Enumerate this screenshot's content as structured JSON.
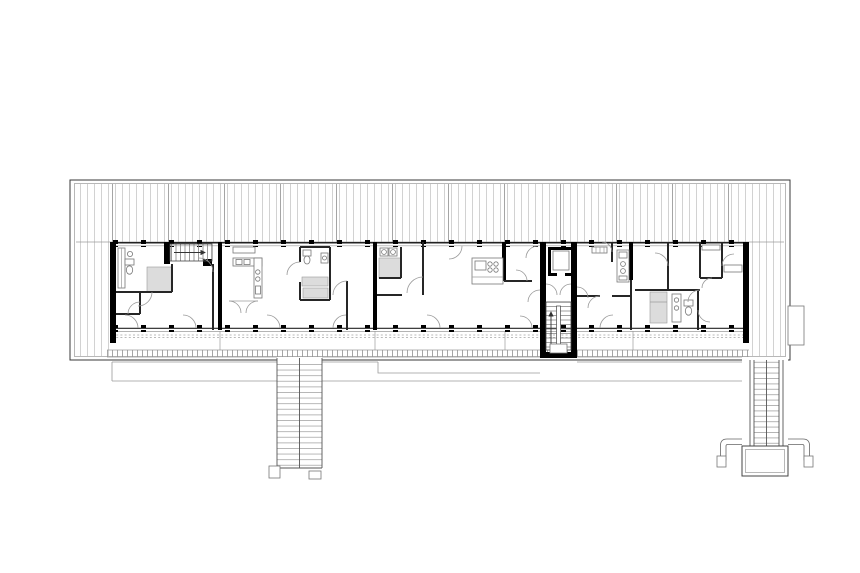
{
  "meta": {
    "title": "Apartment building floor plan",
    "drawing_type": "architectural-floor-plan",
    "visible_text": [],
    "background": "#ffffff"
  },
  "palette": {
    "background": "#ffffff",
    "linework": "#3a3a3a",
    "wall_fill": "#000000",
    "hatch_light": "#c6c6c6",
    "hatch_dark": "#9b9b9b",
    "pod_fill": "#dcdcdc",
    "ground": "#9a9a9a"
  },
  "plan": {
    "building": {
      "orientation": "horizontal slab",
      "roof_hatch_bands": [
        "top",
        "left-end",
        "right-end"
      ],
      "unit_count": 6,
      "facade_columns": "square posts at regular spacing on north and south facades",
      "south_edge": "access gallery with dashed deck line and ticked outer strip"
    },
    "core": {
      "position": "center-right",
      "elements": [
        "elevator",
        "switchback-stair",
        "south-protruding shaft"
      ]
    },
    "external_stairs": [
      {
        "id": "left",
        "type": "double-flight straight stair",
        "feet": 2
      },
      {
        "id": "right",
        "type": "single-flight stair",
        "landing": "rectangular platform with curled wing walls"
      }
    ],
    "unit_fixtures": [
      "internal straight stair with arrow",
      "kitchens with sink and cooktop",
      "gray shower/bath pods",
      "toilets",
      "wash basins",
      "washing machines",
      "wardrobes",
      "door swing arcs"
    ],
    "right_facade_box": "small rectangular annex at mid-height"
  }
}
